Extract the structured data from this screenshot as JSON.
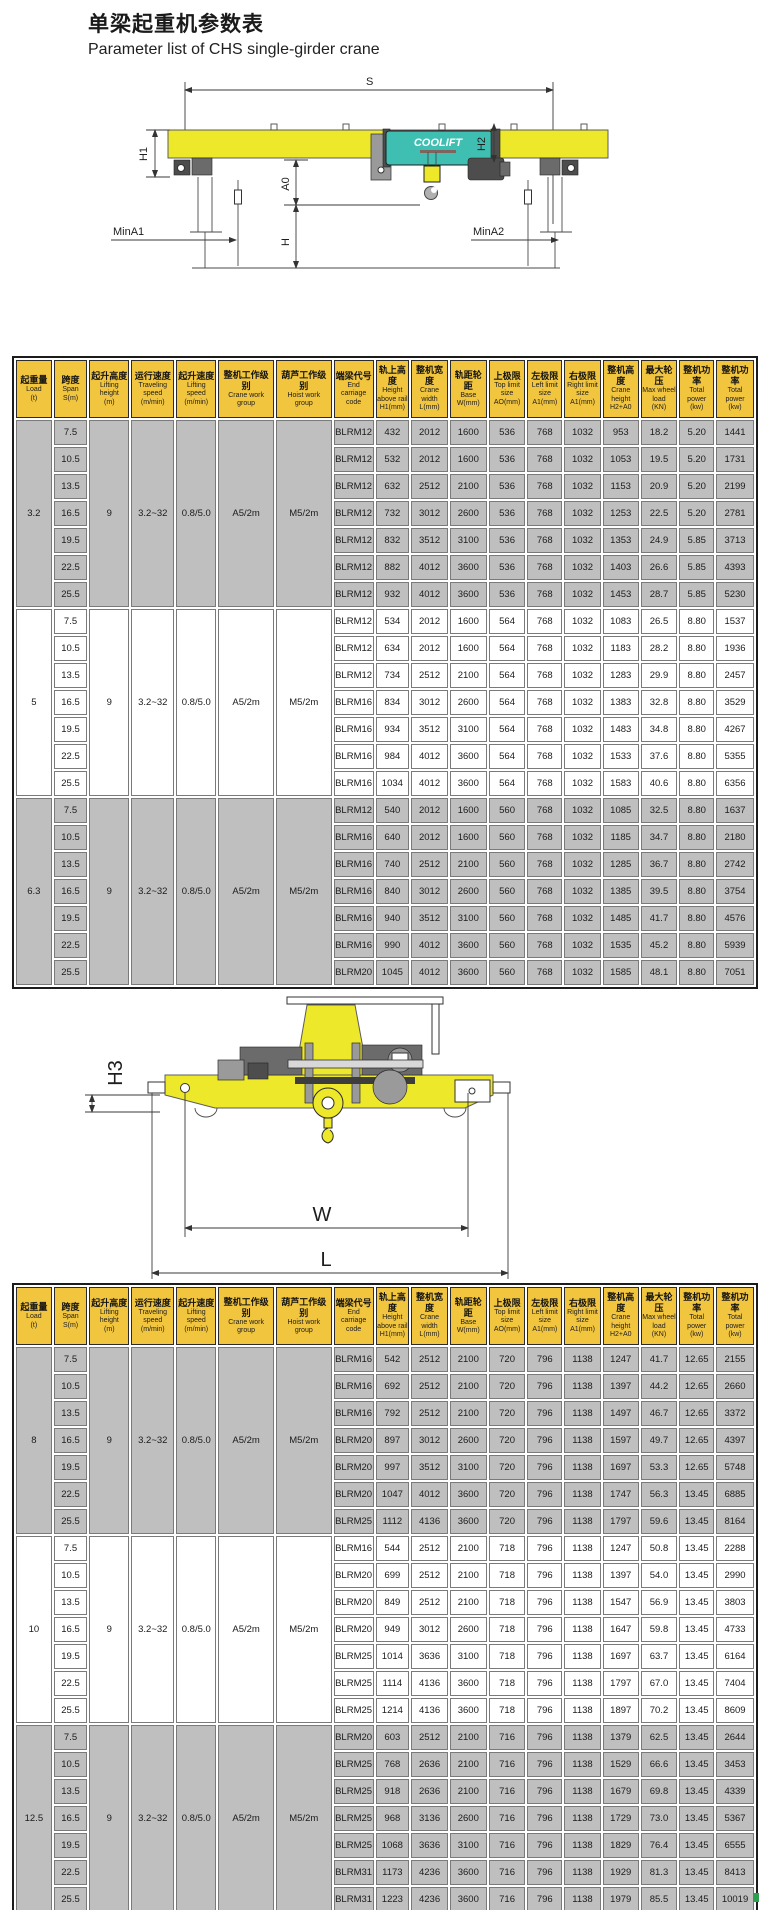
{
  "page": {
    "title_zh": "单梁起重机参数表",
    "title_en": "Parameter list of CHS single-girder crane"
  },
  "diagram1": {
    "span": "S",
    "h1": "H1",
    "h2": "H2",
    "a0": "A0",
    "h": "H",
    "min_a1": "MinA1",
    "min_a2": "MinA2",
    "hoist_logo": "COOLIFT"
  },
  "diagram2": {
    "h3": "H3",
    "w": "W",
    "l": "L"
  },
  "colors": {
    "header_yellow": "#F2C53F",
    "girder_yellow": "#EDE829",
    "hoist_teal": "#3EBFB2",
    "row_gray": "#BFBFBF",
    "row_white": "#FFFFFF"
  },
  "table_header": {
    "columns": [
      {
        "zh": "起重量",
        "en": [
          "Load",
          "(t)"
        ]
      },
      {
        "zh": "跨度",
        "en": [
          "Span",
          "S(m)"
        ]
      },
      {
        "zh": "起升高度",
        "en": [
          "Lifting",
          "height",
          "(m)"
        ]
      },
      {
        "zh": "运行速度",
        "en": [
          "Traveling",
          "speed",
          "(m/min)"
        ]
      },
      {
        "zh": "起升速度",
        "en": [
          "Lifting",
          "speed",
          "(m/min)"
        ]
      },
      {
        "zh": "整机工作级别",
        "en": [
          "Crane work",
          "group"
        ]
      },
      {
        "zh": "葫芦工作级别",
        "en": [
          "Hoist work",
          "group"
        ]
      },
      {
        "zh": "端梁代号",
        "en": [
          "End",
          "carriage",
          "code"
        ]
      },
      {
        "zh": "轨上高度",
        "en": [
          "Height",
          "above rail",
          "H1(mm)"
        ]
      },
      {
        "zh": "整机宽度",
        "en": [
          "Crane",
          "width",
          "L(mm)"
        ]
      },
      {
        "zh": "轨距轮距",
        "en": [
          "Base",
          "W(mm)"
        ]
      },
      {
        "zh": "上极限",
        "en": [
          "Top limit",
          "size",
          "AO(mm)"
        ]
      },
      {
        "zh": "左极限",
        "en": [
          "Left limit",
          "size",
          "A1(mm)"
        ]
      },
      {
        "zh": "右极限",
        "en": [
          "Right limit",
          "size",
          "A1(mm)"
        ]
      },
      {
        "zh": "整机高度",
        "en": [
          "Crane",
          "height",
          "H2+A0"
        ]
      },
      {
        "zh": "最大轮压",
        "en": [
          "Max wheel",
          "load",
          "(KN)"
        ]
      },
      {
        "zh": "整机功率",
        "en": [
          "Total",
          "power",
          "(kw)"
        ]
      },
      {
        "zh": "整机功率",
        "en": [
          "Total",
          "power",
          "(kw)"
        ]
      }
    ]
  },
  "table1": {
    "groups": [
      {
        "load": "3.2",
        "shade": "gray",
        "common": [
          "9",
          "3.2~32",
          "0.8/5.0",
          "A5/2m",
          "M5/2m"
        ],
        "rows": [
          [
            "7.5",
            "BLRM12",
            "432",
            "2012",
            "1600",
            "536",
            "768",
            "1032",
            "953",
            "18.2",
            "5.20",
            "1441"
          ],
          [
            "10.5",
            "BLRM12",
            "532",
            "2012",
            "1600",
            "536",
            "768",
            "1032",
            "1053",
            "19.5",
            "5.20",
            "1731"
          ],
          [
            "13.5",
            "BLRM12",
            "632",
            "2512",
            "2100",
            "536",
            "768",
            "1032",
            "1153",
            "20.9",
            "5.20",
            "2199"
          ],
          [
            "16.5",
            "BLRM12",
            "732",
            "3012",
            "2600",
            "536",
            "768",
            "1032",
            "1253",
            "22.5",
            "5.20",
            "2781"
          ],
          [
            "19.5",
            "BLRM12",
            "832",
            "3512",
            "3100",
            "536",
            "768",
            "1032",
            "1353",
            "24.9",
            "5.85",
            "3713"
          ],
          [
            "22.5",
            "BLRM12",
            "882",
            "4012",
            "3600",
            "536",
            "768",
            "1032",
            "1403",
            "26.6",
            "5.85",
            "4393"
          ],
          [
            "25.5",
            "BLRM12",
            "932",
            "4012",
            "3600",
            "536",
            "768",
            "1032",
            "1453",
            "28.7",
            "5.85",
            "5230"
          ]
        ]
      },
      {
        "load": "5",
        "shade": "white",
        "common": [
          "9",
          "3.2~32",
          "0.8/5.0",
          "A5/2m",
          "M5/2m"
        ],
        "rows": [
          [
            "7.5",
            "BLRM12",
            "534",
            "2012",
            "1600",
            "564",
            "768",
            "1032",
            "1083",
            "26.5",
            "8.80",
            "1537"
          ],
          [
            "10.5",
            "BLRM12",
            "634",
            "2012",
            "1600",
            "564",
            "768",
            "1032",
            "1183",
            "28.2",
            "8.80",
            "1936"
          ],
          [
            "13.5",
            "BLRM12",
            "734",
            "2512",
            "2100",
            "564",
            "768",
            "1032",
            "1283",
            "29.9",
            "8.80",
            "2457"
          ],
          [
            "16.5",
            "BLRM16",
            "834",
            "3012",
            "2600",
            "564",
            "768",
            "1032",
            "1383",
            "32.8",
            "8.80",
            "3529"
          ],
          [
            "19.5",
            "BLRM16",
            "934",
            "3512",
            "3100",
            "564",
            "768",
            "1032",
            "1483",
            "34.8",
            "8.80",
            "4267"
          ],
          [
            "22.5",
            "BLRM16",
            "984",
            "4012",
            "3600",
            "564",
            "768",
            "1032",
            "1533",
            "37.6",
            "8.80",
            "5355"
          ],
          [
            "25.5",
            "BLRM16",
            "1034",
            "4012",
            "3600",
            "564",
            "768",
            "1032",
            "1583",
            "40.6",
            "8.80",
            "6356"
          ]
        ]
      },
      {
        "load": "6.3",
        "shade": "gray",
        "common": [
          "9",
          "3.2~32",
          "0.8/5.0",
          "A5/2m",
          "M5/2m"
        ],
        "rows": [
          [
            "7.5",
            "BLRM12",
            "540",
            "2012",
            "1600",
            "560",
            "768",
            "1032",
            "1085",
            "32.5",
            "8.80",
            "1637"
          ],
          [
            "10.5",
            "BLRM16",
            "640",
            "2012",
            "1600",
            "560",
            "768",
            "1032",
            "1185",
            "34.7",
            "8.80",
            "2180"
          ],
          [
            "13.5",
            "BLRM16",
            "740",
            "2512",
            "2100",
            "560",
            "768",
            "1032",
            "1285",
            "36.7",
            "8.80",
            "2742"
          ],
          [
            "16.5",
            "BLRM16",
            "840",
            "3012",
            "2600",
            "560",
            "768",
            "1032",
            "1385",
            "39.5",
            "8.80",
            "3754"
          ],
          [
            "19.5",
            "BLRM16",
            "940",
            "3512",
            "3100",
            "560",
            "768",
            "1032",
            "1485",
            "41.7",
            "8.80",
            "4576"
          ],
          [
            "22.5",
            "BLRM16",
            "990",
            "4012",
            "3600",
            "560",
            "768",
            "1032",
            "1535",
            "45.2",
            "8.80",
            "5939"
          ],
          [
            "25.5",
            "BLRM20",
            "1045",
            "4012",
            "3600",
            "560",
            "768",
            "1032",
            "1585",
            "48.1",
            "8.80",
            "7051"
          ]
        ]
      }
    ]
  },
  "table2": {
    "groups": [
      {
        "load": "8",
        "shade": "gray",
        "common": [
          "9",
          "3.2~32",
          "0.8/5.0",
          "A5/2m",
          "M5/2m"
        ],
        "rows": [
          [
            "7.5",
            "BLRM16",
            "542",
            "2512",
            "2100",
            "720",
            "796",
            "1138",
            "1247",
            "41.7",
            "12.65",
            "2155"
          ],
          [
            "10.5",
            "BLRM16",
            "692",
            "2512",
            "2100",
            "720",
            "796",
            "1138",
            "1397",
            "44.2",
            "12.65",
            "2660"
          ],
          [
            "13.5",
            "BLRM16",
            "792",
            "2512",
            "2100",
            "720",
            "796",
            "1138",
            "1497",
            "46.7",
            "12.65",
            "3372"
          ],
          [
            "16.5",
            "BLRM20",
            "897",
            "3012",
            "2600",
            "720",
            "796",
            "1138",
            "1597",
            "49.7",
            "12.65",
            "4397"
          ],
          [
            "19.5",
            "BLRM20",
            "997",
            "3512",
            "3100",
            "720",
            "796",
            "1138",
            "1697",
            "53.3",
            "12.65",
            "5748"
          ],
          [
            "22.5",
            "BLRM20",
            "1047",
            "4012",
            "3600",
            "720",
            "796",
            "1138",
            "1747",
            "56.3",
            "13.45",
            "6885"
          ],
          [
            "25.5",
            "BLRM25",
            "1112",
            "4136",
            "3600",
            "720",
            "796",
            "1138",
            "1797",
            "59.6",
            "13.45",
            "8164"
          ]
        ]
      },
      {
        "load": "10",
        "shade": "white",
        "common": [
          "9",
          "3.2~32",
          "0.8/5.0",
          "A5/2m",
          "M5/2m"
        ],
        "rows": [
          [
            "7.5",
            "BLRM16",
            "544",
            "2512",
            "2100",
            "718",
            "796",
            "1138",
            "1247",
            "50.8",
            "13.45",
            "2288"
          ],
          [
            "10.5",
            "BLRM20",
            "699",
            "2512",
            "2100",
            "718",
            "796",
            "1138",
            "1397",
            "54.0",
            "13.45",
            "2990"
          ],
          [
            "13.5",
            "BLRM20",
            "849",
            "2512",
            "2100",
            "718",
            "796",
            "1138",
            "1547",
            "56.9",
            "13.45",
            "3803"
          ],
          [
            "16.5",
            "BLRM20",
            "949",
            "3012",
            "2600",
            "718",
            "796",
            "1138",
            "1647",
            "59.8",
            "13.45",
            "4733"
          ],
          [
            "19.5",
            "BLRM25",
            "1014",
            "3636",
            "3100",
            "718",
            "796",
            "1138",
            "1697",
            "63.7",
            "13.45",
            "6164"
          ],
          [
            "22.5",
            "BLRM25",
            "1114",
            "4136",
            "3600",
            "718",
            "796",
            "1138",
            "1797",
            "67.0",
            "13.45",
            "7404"
          ],
          [
            "25.5",
            "BLRM25",
            "1214",
            "4136",
            "3600",
            "718",
            "796",
            "1138",
            "1897",
            "70.2",
            "13.45",
            "8609"
          ]
        ]
      },
      {
        "load": "12.5",
        "shade": "gray",
        "common": [
          "9",
          "3.2~32",
          "0.8/5.0",
          "A5/2m",
          "M5/2m"
        ],
        "rows": [
          [
            "7.5",
            "BLRM20",
            "603",
            "2512",
            "2100",
            "716",
            "796",
            "1138",
            "1379",
            "62.5",
            "13.45",
            "2644"
          ],
          [
            "10.5",
            "BLRM25",
            "768",
            "2636",
            "2100",
            "716",
            "796",
            "1138",
            "1529",
            "66.6",
            "13.45",
            "3453"
          ],
          [
            "13.5",
            "BLRM25",
            "918",
            "2636",
            "2100",
            "716",
            "796",
            "1138",
            "1679",
            "69.8",
            "13.45",
            "4339"
          ],
          [
            "16.5",
            "BLRM25",
            "968",
            "3136",
            "2600",
            "716",
            "796",
            "1138",
            "1729",
            "73.0",
            "13.45",
            "5367"
          ],
          [
            "19.5",
            "BLRM25",
            "1068",
            "3636",
            "3100",
            "716",
            "796",
            "1138",
            "1829",
            "76.4",
            "13.45",
            "6555"
          ],
          [
            "22.5",
            "BLRM31",
            "1173",
            "4236",
            "3600",
            "716",
            "796",
            "1138",
            "1929",
            "81.3",
            "13.45",
            "8413"
          ],
          [
            "25.5",
            "BLRM31",
            "1223",
            "4236",
            "3600",
            "716",
            "796",
            "1138",
            "1979",
            "85.5",
            "13.45",
            "10019"
          ]
        ]
      }
    ]
  }
}
